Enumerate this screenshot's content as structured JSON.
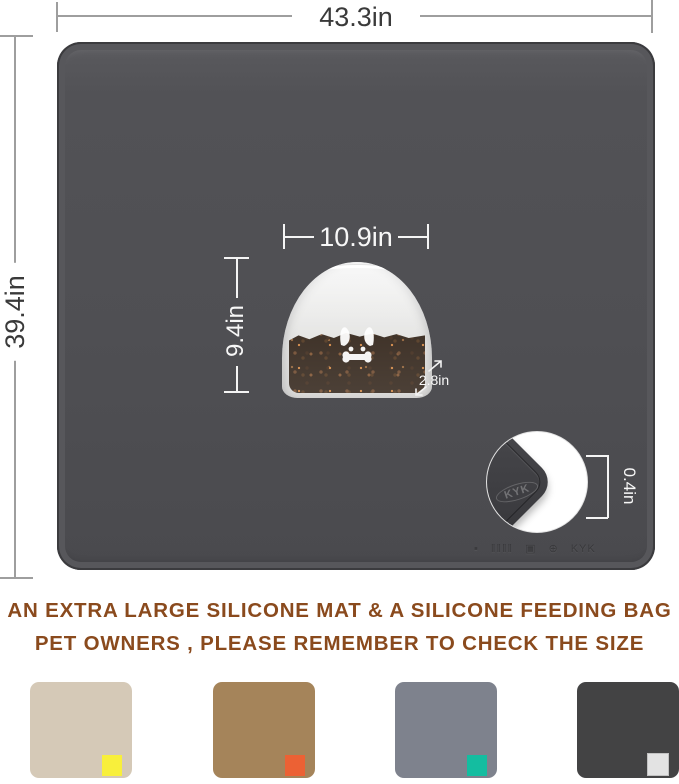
{
  "dimension_labels": {
    "mat_width": "43.3in",
    "mat_height": "39.4in",
    "bag_width": "10.9in",
    "bag_height": "9.4in",
    "bag_depth": "2.8in",
    "mat_thickness": "0.4in"
  },
  "mat": {
    "surface_color": "#4f4f53",
    "embossed_marks": {
      "dot": "▪",
      "barcode": "‖‖‖‖",
      "box": "▣",
      "seal": "⊕",
      "logo": "KYK"
    }
  },
  "inset": {
    "logo": "KYK"
  },
  "heading": {
    "line1": "AN EXTRA LARGE SILICONE MAT & A SILICONE FEEDING BAG",
    "line2": "PET OWNERS , PLEASE REMEMBER TO CHECK THE SIZE",
    "color": "#8a4a1d"
  },
  "swatches": [
    {
      "name": "beige mat",
      "color": "#d5c9b7",
      "chip_color": "#f8ef3b"
    },
    {
      "name": "brown mat",
      "color": "#a5845a",
      "chip_color": "#ec6134"
    },
    {
      "name": "gray mat",
      "color": "#7e828d",
      "chip_color": "#14bda0"
    },
    {
      "name": "charcoal mat",
      "color": "#434344",
      "chip_color": "#e3e3e3",
      "chip_border": "#c2c2c2"
    }
  ],
  "colors": {
    "dimension_text_dark": "#3a3a3a",
    "dimension_text_light": "#f7f7f7",
    "dimension_line_gray": "#9e9e9e"
  }
}
